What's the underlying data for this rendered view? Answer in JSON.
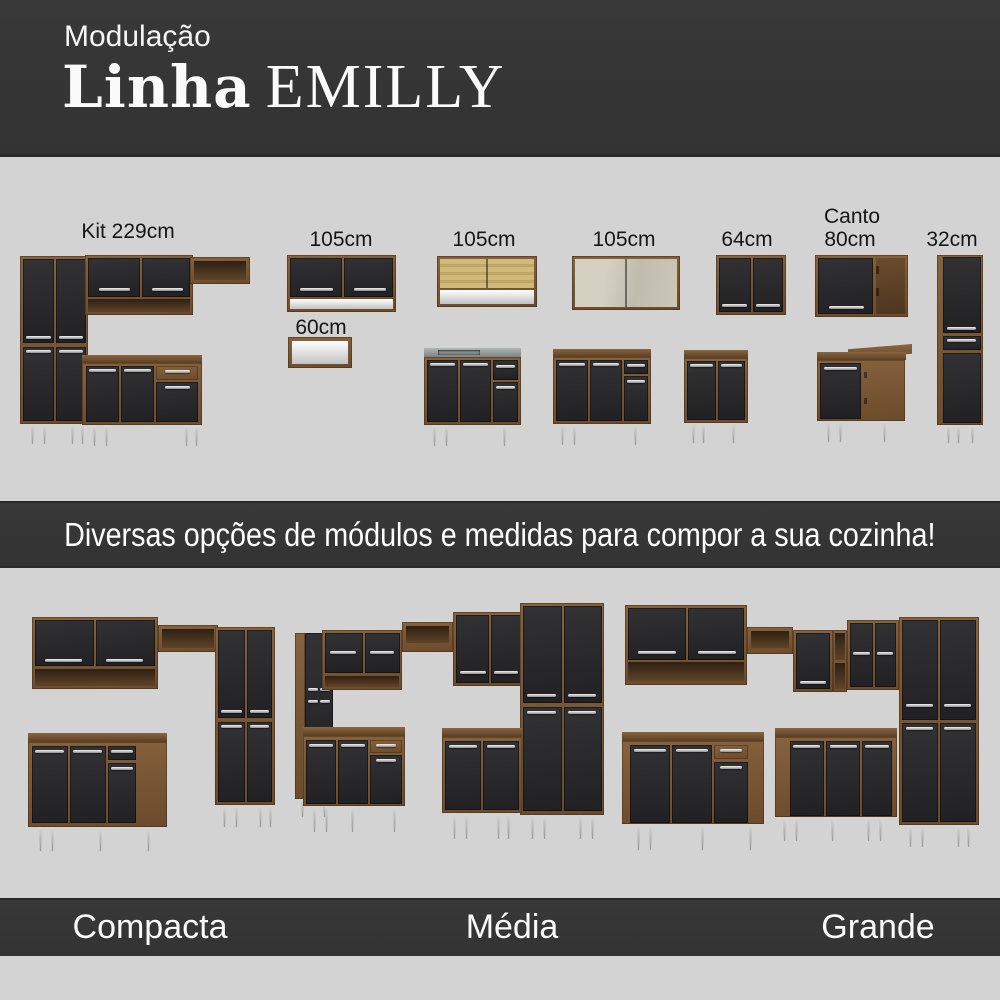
{
  "header": {
    "eyebrow": "Modulação",
    "title_bold": "Linha",
    "title_light": "EMILLY"
  },
  "banner": {
    "text": "Diversas opções de módulos e medidas para compor a sua cozinha!"
  },
  "modules": {
    "kit": {
      "label": "Kit 229cm"
    },
    "wall105a": {
      "label": "105cm"
    },
    "wall60": {
      "label": "60cm"
    },
    "wall105b": {
      "label": "105cm"
    },
    "wall105c": {
      "label": "105cm"
    },
    "wall64": {
      "label": "64cm"
    },
    "corner80": {
      "line1": "Canto",
      "line2": "80cm"
    },
    "tall32": {
      "label": "32cm"
    }
  },
  "sets": [
    {
      "name": "Compacta"
    },
    {
      "name": "Média"
    },
    {
      "name": "Grande"
    }
  ],
  "colors": {
    "band_dark": "#343434",
    "background_gray": "#d3d3d3",
    "text_light": "#ffffff",
    "text_dark": "#161616",
    "wood_brown": "#7a5a39",
    "door_black": "#28282b",
    "handle_silver": "#dcdcdc",
    "leg_silver": "#b5b5b5",
    "countertop_steel": "#8d9595"
  }
}
